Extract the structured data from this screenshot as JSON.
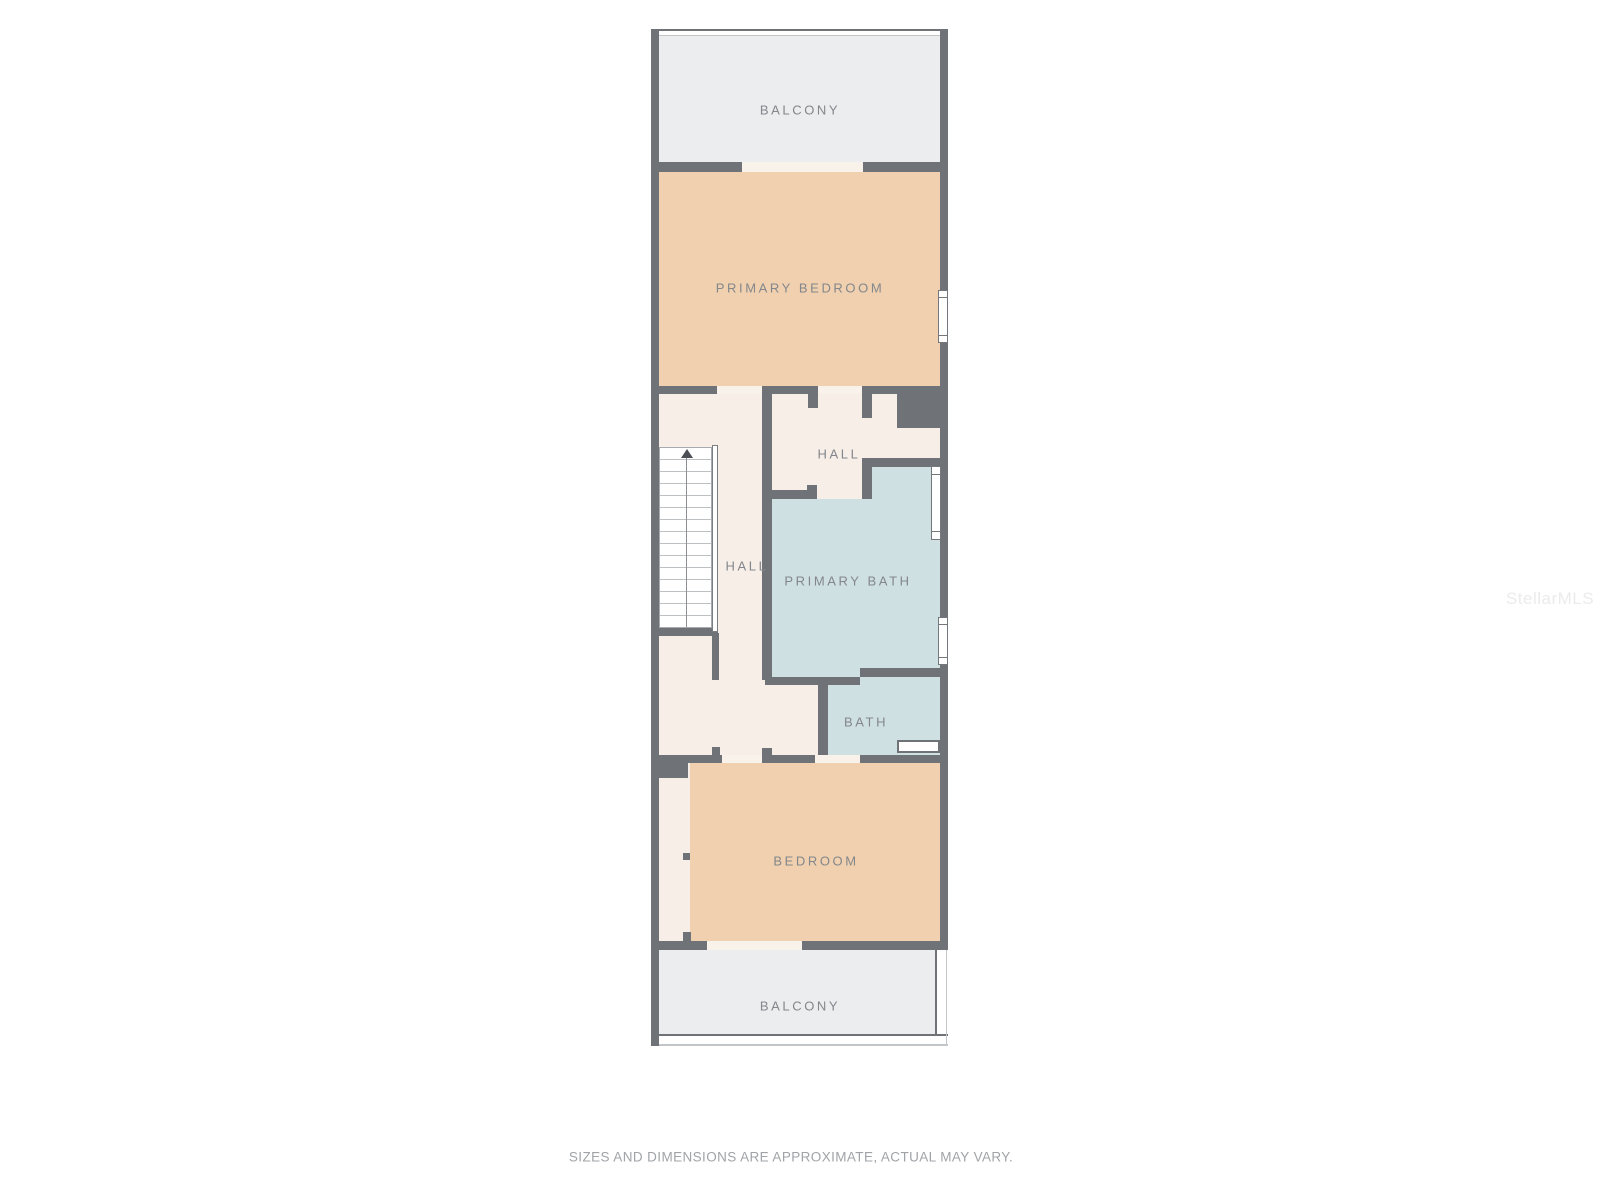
{
  "plan": {
    "rooms": {
      "balcony_top": "BALCONY",
      "primary_bedroom": "PRIMARY BEDROOM",
      "hall_upper": "HALL",
      "hall_stairs": "HALL",
      "primary_bath": "PRIMARY BATH",
      "bath": "BATH",
      "bedroom": "BEDROOM",
      "balcony_bottom": "BALCONY"
    },
    "colors": {
      "wall": "#6f7378",
      "balcony": "#ebedee",
      "bedroom": "#f0d0ae",
      "hall": "#f6eee7",
      "bath": "#cfe0e2",
      "label": "#83878c"
    }
  },
  "footer": {
    "disclaimer": "SIZES AND DIMENSIONS ARE APPROXIMATE, ACTUAL MAY VARY."
  },
  "watermark": {
    "text": "StellarMLS"
  }
}
